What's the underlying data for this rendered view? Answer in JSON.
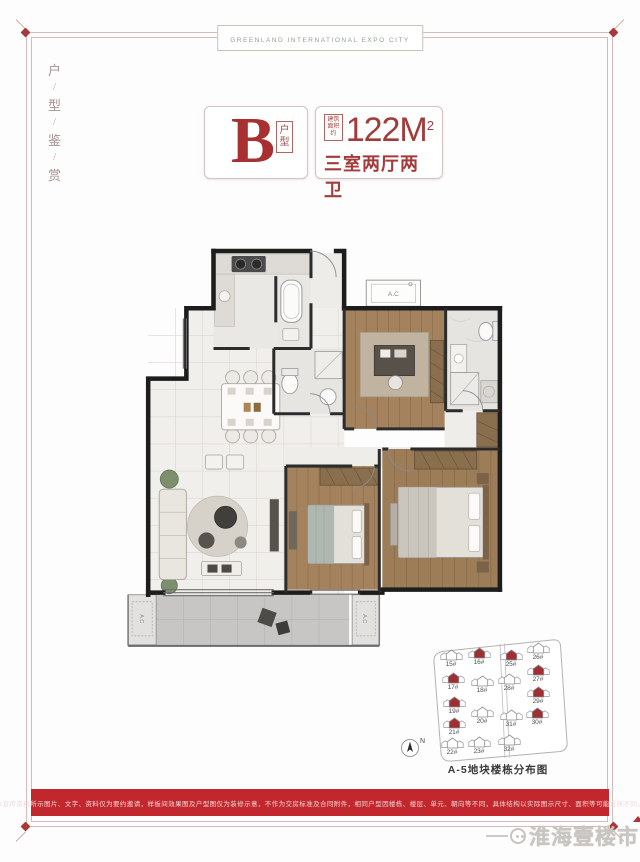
{
  "banner": {
    "text": "GREENLAND INTERNATIONAL EXPO CITY"
  },
  "side_label": {
    "chars": [
      "户",
      "/",
      "型",
      "/",
      "鉴",
      "/",
      "赏"
    ]
  },
  "unit": {
    "letter": "B",
    "letter_tag": "户型",
    "area_note_line1": "建筑",
    "area_note_line2": "面积约",
    "area": "122M",
    "area_exp": "2",
    "rooms": "三室两厅两卫"
  },
  "floorplan": {
    "ac": "A.C"
  },
  "siteplan": {
    "compass": "N",
    "caption": "A-5地块楼栋分布图",
    "buildings": [
      {
        "label": "15#",
        "state": "normal"
      },
      {
        "label": "16#",
        "state": "highlighted"
      },
      {
        "label": "17#",
        "state": "highlighted"
      },
      {
        "label": "18#",
        "state": "normal"
      },
      {
        "label": "19#",
        "state": "highlighted"
      },
      {
        "label": "20#",
        "state": "normal"
      },
      {
        "label": "21#",
        "state": "highlighted"
      },
      {
        "label": "22#",
        "state": "normal"
      },
      {
        "label": "23#",
        "state": "normal"
      },
      {
        "label": "25#",
        "state": "highlighted"
      },
      {
        "label": "26#",
        "state": "normal"
      },
      {
        "label": "27#",
        "state": "highlighted"
      },
      {
        "label": "28#",
        "state": "normal"
      },
      {
        "label": "29#",
        "state": "highlighted"
      },
      {
        "label": "30#",
        "state": "highlighted"
      },
      {
        "label": "31#",
        "state": "normal"
      },
      {
        "label": "32#",
        "state": "normal"
      }
    ]
  },
  "disclaimer": "本宣传资料所示图片、文字、资料仅为要约邀请，样板间效果图及户型图仅为装修示意，不作为交房标准及合同附件，相同户型因楼栋、楼层、单元、朝向等不同，具体结构以实际图示尺寸、面积等可能有所不同。",
  "watermark": {
    "name": "淮海壹楼市"
  },
  "colors": {
    "accent_red": "#a43b3b",
    "bar_red": "#c1272d",
    "highlight_building": "#9e2f35",
    "frame_pink": "#d4baba"
  }
}
